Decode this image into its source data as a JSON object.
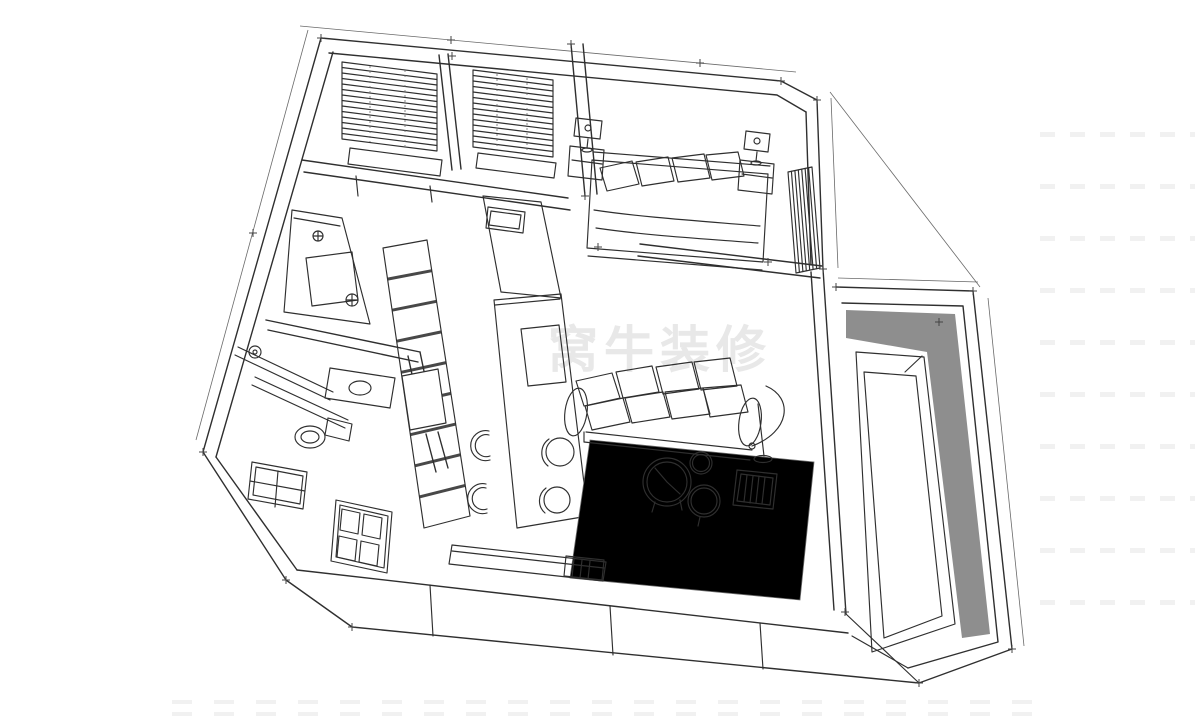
{
  "meta": {
    "title": "Hand-drawn axonometric apartment floor-plan sketch",
    "style": "pencil line drawing on white"
  },
  "theme": {
    "background": "#ffffff",
    "ink": "#2f2f2f",
    "light_ink": "#6a6a6a",
    "balcony_band": "#8e8e8e",
    "watermark_color": "#e8e8e8"
  },
  "watermark": {
    "text": "窝牛装修"
  },
  "rooms": [
    {
      "id": "dressing-room",
      "features": [
        "venetian-blind-window-left",
        "venetian-blind-window-right",
        "window-bench"
      ]
    },
    {
      "id": "bedroom",
      "features": [
        "double-bed",
        "pillows",
        "nightstand-left",
        "table-lamp-left",
        "nightstand-right",
        "table-lamp-right",
        "slatted-wardrobe"
      ]
    },
    {
      "id": "bathroom",
      "features": [
        "glass-shower-panels",
        "floor-drain",
        "vanity-basin",
        "toilet",
        "exterior-window"
      ]
    },
    {
      "id": "kitchen",
      "features": [
        "wall-counter",
        "cooktop-hatch",
        "striped-cabinet-run",
        "sink-hatch",
        "island-peninsula",
        "wall-niche",
        "bar-stools"
      ]
    },
    {
      "id": "living-room",
      "features": [
        "sofa",
        "seat-cushions",
        "arm-rests",
        "arc-floor-lamp",
        "round-coffee-table-large",
        "round-coffee-table-small",
        "round-side-top",
        "pouf-stools",
        "slatted-side-table",
        "area-rug",
        "tv-console"
      ]
    },
    {
      "id": "entry",
      "features": [
        "paneled-door",
        "lower-wall-window"
      ]
    },
    {
      "id": "balcony",
      "features": [
        "parapet-walls",
        "gray-floor-border",
        "inner-floor-frames"
      ]
    }
  ]
}
